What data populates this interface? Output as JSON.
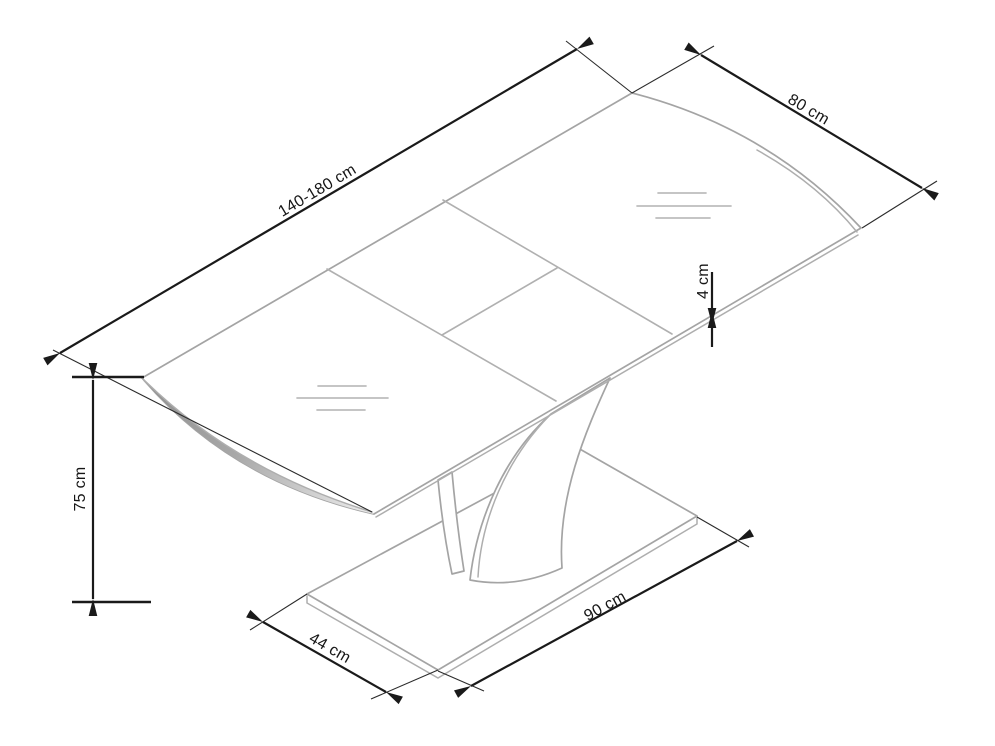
{
  "page": {
    "background_color": "#ffffff",
    "subject": "extendable pedestal table technical dimension drawing"
  },
  "drawing": {
    "style": {
      "dimension_color": "#1a1a1a",
      "outline_color": "#a4a4a4",
      "edge_shade_color": "#8e8e8e"
    },
    "dimensions": {
      "tabletop_length": {
        "label": "140-180 cm"
      },
      "tabletop_width": {
        "label": "80 cm"
      },
      "tabletop_thickness": {
        "label": "4 cm"
      },
      "table_height": {
        "label": "75 cm"
      },
      "base_depth": {
        "label": "44 cm"
      },
      "base_length": {
        "label": "90 cm"
      }
    }
  }
}
